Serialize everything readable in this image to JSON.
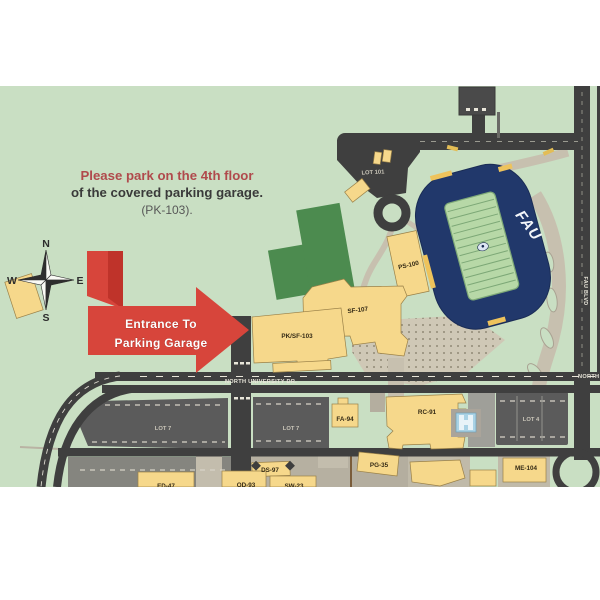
{
  "note": {
    "line1": "Please park on the 4th floor",
    "line2": "of the covered parking garage.",
    "line3": "(PK-103)."
  },
  "compass": {
    "n": "N",
    "e": "E",
    "s": "S",
    "w": "W"
  },
  "entrance_arrow": {
    "line1": "Entrance To",
    "line2": "Parking Garage"
  },
  "roads": {
    "north_university_dr": "NORTH UNIVERSITY DR.",
    "fau_blvd": "FAU BLVD"
  },
  "stadium": {
    "label": "FAU"
  },
  "parking_lots": {
    "lot101": "LOT 101",
    "lot7_west": "LOT 7",
    "lot7_east": "LOT 7",
    "lot4": "LOT 4"
  },
  "buildings": {
    "ps100": "PS-100",
    "sf107": "SF-107",
    "pk_sf103": "PK/SF-103",
    "fa94": "FA-94",
    "rc91": "RC-91",
    "pg35": "PG-35",
    "me104": "ME-104",
    "ds97": "DS-97",
    "ed47": "ED-47",
    "od93": "OD-93",
    "sw23": "SW-23"
  },
  "colors": {
    "map_background": "#c9dfc3",
    "road": "#3f3f3f",
    "parking_lot": "#5b5b5b",
    "building": "#f6d88b",
    "stadium_navy": "#21386b",
    "practice_field": "#4c8b4f",
    "arrow_red": "#d7453b",
    "note_red": "#b04a4c"
  }
}
